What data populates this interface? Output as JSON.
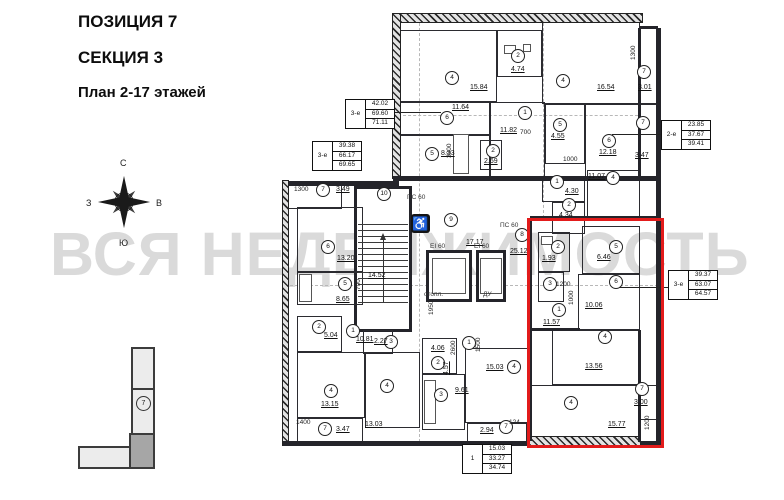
{
  "title": {
    "line1": "ПОЗИЦИЯ 7",
    "line2": "СЕКЦИЯ 3",
    "line3": "План 2-17 этажей"
  },
  "watermark": "ВСЯ НЕДВИЖИМОСТЬ",
  "compass": {
    "north": "С",
    "south": "Ю",
    "east": "В",
    "west": "З"
  },
  "locator": {
    "section_number": "7"
  },
  "colors": {
    "highlight_red": "#e21b1b",
    "watermark_gray": "#c4c4c4",
    "wall_dark": "#24242a"
  },
  "plan": {
    "unit_tables": [
      {
        "label": "3-е",
        "values": [
          "42.02",
          "69.60",
          "71.11"
        ],
        "x": 345,
        "y": 99
      },
      {
        "label": "3-е",
        "values": [
          "39.38",
          "66.17",
          "69.65"
        ],
        "x": 312,
        "y": 141
      },
      {
        "label": "2-е",
        "values": [
          "23.85",
          "37.67",
          "39.41"
        ],
        "x": 661,
        "y": 120
      },
      {
        "label": "3-е",
        "values": [
          "39.37",
          "63.07",
          "64.57"
        ],
        "x": 668,
        "y": 270
      },
      {
        "label": "1",
        "values": [
          "15.03",
          "33.27",
          "34.74"
        ],
        "x": 462,
        "y": 444
      }
    ],
    "rooms": [
      {
        "n": "4",
        "a": "15.84",
        "cx": 451,
        "cy": 77,
        "ax": 470,
        "ay": 84,
        "rect": [
          397,
          30,
          100,
          72
        ]
      },
      {
        "n": "2",
        "a": "4.74",
        "cx": 517,
        "cy": 55,
        "ax": 511,
        "ay": 66,
        "rect": [
          497,
          30,
          45,
          47
        ]
      },
      {
        "n": "4",
        "a": "16.54",
        "cx": 562,
        "cy": 80,
        "ax": 597,
        "ay": 84,
        "rect": [
          542,
          22,
          98,
          82
        ]
      },
      {
        "n": "6",
        "a": "11.64",
        "cx": 446,
        "cy": 117,
        "ax": 452,
        "ay": 104,
        "rect": [
          397,
          102,
          93,
          33
        ]
      },
      {
        "n": "5",
        "a": "8.33",
        "cx": 431,
        "cy": 153,
        "ax": 441,
        "ay": 150,
        "rect": [
          397,
          135,
          93,
          43
        ]
      },
      {
        "n": "2",
        "a": "2.69",
        "cx": 492,
        "cy": 150,
        "ax": 484,
        "ay": 158,
        "rect": [
          480,
          140,
          22,
          30
        ]
      },
      {
        "n": "1",
        "a": "11.82",
        "cx": 524,
        "cy": 112,
        "ax": 500,
        "ay": 127,
        "rect": [
          490,
          102,
          55,
          76
        ]
      },
      {
        "n": "5",
        "a": "4.55",
        "cx": 559,
        "cy": 124,
        "ax": 551,
        "ay": 133,
        "rect": [
          545,
          104,
          40,
          60
        ]
      },
      {
        "n": "6",
        "a": "12.18",
        "cx": 608,
        "cy": 140,
        "ax": 599,
        "ay": 149,
        "rect": [
          585,
          104,
          55,
          74
        ]
      },
      {
        "n": "7",
        "a": "3.01",
        "cx": 643,
        "cy": 71,
        "ax": 638,
        "ay": 84,
        "rect": [
          640,
          28,
          18,
          76
        ]
      },
      {
        "n": "7",
        "a": "3.47",
        "cx": 642,
        "cy": 122,
        "ax": 635,
        "ay": 152,
        "rect": [
          640,
          104,
          18,
          74
        ]
      },
      {
        "n": "1",
        "a": "4.30",
        "cx": 556,
        "cy": 181,
        "ax": 565,
        "ay": 188,
        "rect": [
          542,
          176,
          43,
          26
        ]
      },
      {
        "n": "2",
        "a": "4.34",
        "cx": 568,
        "cy": 204,
        "ax": 559,
        "ay": 212,
        "rect": [
          552,
          202,
          33,
          32
        ]
      },
      {
        "n": "4",
        "a": "11.07",
        "cx": 612,
        "cy": 177,
        "ax": 588,
        "ay": 173,
        "rect": [
          587,
          170,
          53,
          48
        ]
      },
      {
        "n": "7",
        "a": "3.49",
        "cx": 322,
        "cy": 189,
        "ax": 336,
        "ay": 186,
        "rect": [
          286,
          183,
          56,
          26
        ]
      },
      {
        "n": "6",
        "a": "13.20",
        "cx": 327,
        "cy": 246,
        "ax": 337,
        "ay": 255,
        "rect": [
          297,
          207,
          66,
          65
        ]
      },
      {
        "n": "5",
        "a": "8.65",
        "cx": 344,
        "cy": 283,
        "ax": 336,
        "ay": 296,
        "rect": [
          297,
          272,
          66,
          33
        ]
      },
      {
        "n": "2",
        "a": "5.04",
        "cx": 318,
        "cy": 326,
        "ax": 324,
        "ay": 332,
        "rect": [
          297,
          316,
          45,
          36
        ]
      },
      {
        "n": "1",
        "a": "10.81",
        "cx": 352,
        "cy": 330,
        "ax": 356,
        "ay": 336
      },
      {
        "n": "3",
        "a": "2.27",
        "cx": 390,
        "cy": 341,
        "ax": 374,
        "ay": 338,
        "rect": [
          363,
          330,
          30,
          24
        ]
      },
      {
        "n": "4",
        "a": "13.15",
        "cx": 330,
        "cy": 390,
        "ax": 321,
        "ay": 401,
        "rect": [
          297,
          352,
          68,
          66
        ]
      },
      {
        "n": "7",
        "a": "3.47",
        "cx": 324,
        "cy": 428,
        "ax": 336,
        "ay": 426,
        "rect": [
          297,
          418,
          66,
          25
        ]
      },
      {
        "n": "4",
        "a": "13.03",
        "cx": 386,
        "cy": 385,
        "ax": 365,
        "ay": 421,
        "rect": [
          365,
          352,
          55,
          76
        ]
      },
      {
        "n": "2",
        "a": "4.06",
        "cx": 437,
        "cy": 362,
        "ax": 431,
        "ay": 345,
        "rect": [
          422,
          338,
          35,
          36
        ]
      },
      {
        "n": "3",
        "a": "9.61",
        "cx": 440,
        "cy": 394,
        "ax": 455,
        "ay": 387,
        "rect": [
          422,
          374,
          43,
          56
        ]
      },
      {
        "n": "1",
        "a": "4.57",
        "cx": 468,
        "cy": 342,
        "ax": 443,
        "ay": 375,
        "av": 1
      },
      {
        "n": "4",
        "a": "15.03",
        "cx": 513,
        "cy": 366,
        "ax": 486,
        "ay": 364,
        "rect": [
          465,
          348,
          65,
          75
        ]
      },
      {
        "n": "7",
        "a": "2.94",
        "cx": 505,
        "cy": 426,
        "ax": 480,
        "ay": 427,
        "rect": [
          467,
          423,
          60,
          21
        ]
      },
      {
        "n": "8",
        "a": "25.12",
        "cx": 521,
        "cy": 234,
        "ax": 510,
        "ay": 248
      },
      {
        "n": "9",
        "a": "17.17",
        "cx": 450,
        "cy": 219,
        "ax": 466,
        "ay": 239
      },
      {
        "n": "10",
        "a": "14.52",
        "cx": 383,
        "cy": 193,
        "ax": 368,
        "ay": 272
      },
      {
        "n": "2",
        "a": "1.93",
        "cx": 557,
        "cy": 246,
        "ax": 542,
        "ay": 255,
        "rect": [
          538,
          232,
          32,
          40
        ]
      },
      {
        "n": "3",
        "cx": 549,
        "cy": 283,
        "rect": [
          538,
          272,
          26,
          30
        ]
      },
      {
        "n": "5",
        "a": "6.46",
        "cx": 615,
        "cy": 246,
        "ax": 597,
        "ay": 254,
        "rect": [
          582,
          226,
          58,
          48
        ]
      },
      {
        "n": "6",
        "a": "10.06",
        "cx": 615,
        "cy": 281,
        "ax": 585,
        "ay": 302,
        "rect": [
          578,
          274,
          62,
          56
        ]
      },
      {
        "n": "1",
        "a": "11.57",
        "cx": 558,
        "cy": 309,
        "ax": 543,
        "ay": 319
      },
      {
        "n": "4",
        "a": "13.56",
        "cx": 604,
        "cy": 336,
        "ax": 585,
        "ay": 363,
        "rect": [
          552,
          330,
          88,
          55
        ]
      },
      {
        "n": "4",
        "a": "15.77",
        "cx": 570,
        "cy": 402,
        "ax": 608,
        "ay": 421,
        "rect": [
          530,
          385,
          110,
          56
        ]
      },
      {
        "n": "7",
        "a": "3.00",
        "cx": 641,
        "cy": 388,
        "ax": 634,
        "ay": 399,
        "rect": [
          640,
          385,
          20,
          35
        ]
      }
    ],
    "dims": [
      {
        "t": "1300",
        "x": 294,
        "y": 186
      },
      {
        "t": "1400",
        "x": 296,
        "y": 419
      },
      {
        "t": "700",
        "x": 355,
        "y": 290,
        "v": 1
      },
      {
        "t": "3000",
        "x": 446,
        "y": 158,
        "v": 1
      },
      {
        "t": "700",
        "x": 520,
        "y": 129
      },
      {
        "t": "1000",
        "x": 563,
        "y": 156
      },
      {
        "t": "1300",
        "x": 630,
        "y": 60,
        "v": 1
      },
      {
        "t": "1200",
        "x": 556,
        "y": 281
      },
      {
        "t": "1000",
        "x": 568,
        "y": 305,
        "v": 1
      },
      {
        "t": "2600",
        "x": 450,
        "y": 355,
        "v": 1
      },
      {
        "t": "1500",
        "x": 475,
        "y": 352,
        "v": 1
      },
      {
        "t": "1950",
        "x": 428,
        "y": 315,
        "v": 1
      },
      {
        "t": "1200",
        "x": 644,
        "y": 430,
        "v": 1
      },
      {
        "t": "124",
        "x": 509,
        "y": 419
      }
    ],
    "notes": [
      {
        "t": "ПС 60",
        "x": 407,
        "y": 194
      },
      {
        "t": "ПС 60",
        "x": 500,
        "y": 222
      },
      {
        "t": "EI 60",
        "x": 430,
        "y": 243
      },
      {
        "t": "EI 60",
        "x": 474,
        "y": 243
      },
      {
        "t": "отопл.",
        "x": 424,
        "y": 291
      },
      {
        "t": "ДУ",
        "x": 483,
        "y": 291
      }
    ]
  }
}
